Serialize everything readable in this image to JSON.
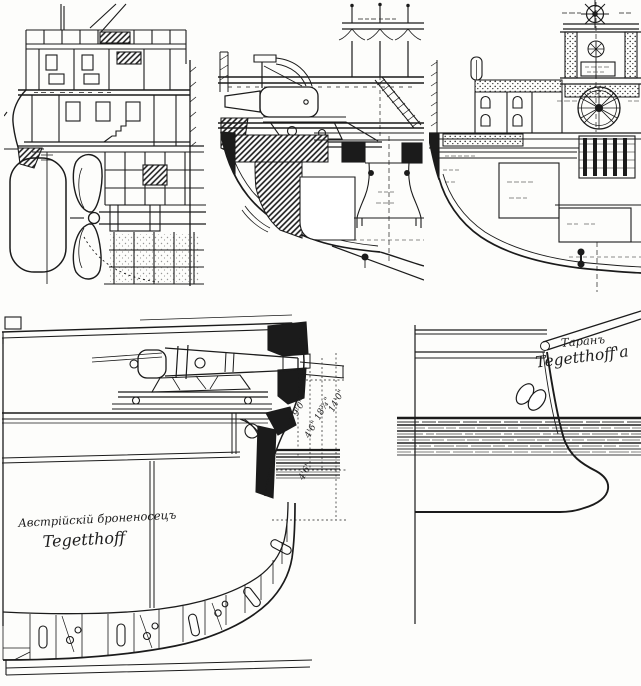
{
  "colors": {
    "paper": "#fdfdfb",
    "ink": "#1b1b1b",
    "hatch_gray": "#444444"
  },
  "midship_label": {
    "line1": "Австрійскій броненосецъ",
    "line2": "Tegetthoff"
  },
  "ram_label": {
    "line1": "Таранъ",
    "line2": "Tegetthoff'а"
  },
  "dimensions": {
    "d1": "9'0\"",
    "d2": "4'6\"",
    "d3": "18¾\"",
    "d4": "14'0\"",
    "d5": "4'6\""
  }
}
